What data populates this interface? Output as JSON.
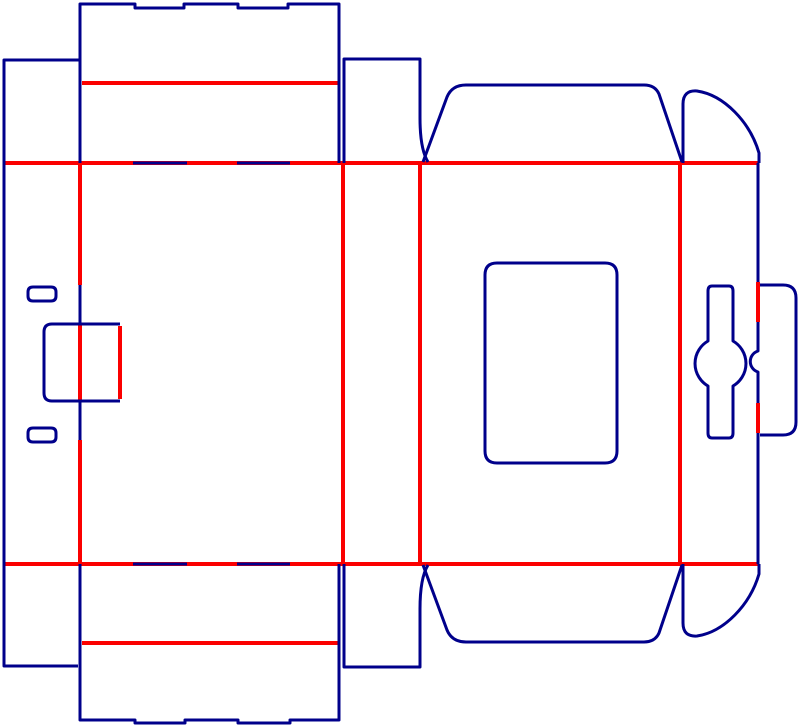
{
  "diagram": {
    "type": "packaging-dieline",
    "description": "Die-line template of a tuck/lock carton: cut lines in dark blue, crease (fold) lines in red",
    "canvas": {
      "width": 800,
      "height": 728,
      "background": "#ffffff"
    },
    "colors": {
      "cut": "#00008B",
      "crease": "#FB0000"
    },
    "stroke_width": {
      "cut": 3,
      "crease": 4
    },
    "crease_paths": [
      {
        "name": "fold-line-top",
        "d": "M 4,163 H 758"
      },
      {
        "name": "fold-line-bottom",
        "d": "M 4,564 H 758"
      },
      {
        "name": "top-tuck-flap-crease",
        "d": "M 82,83 H 338"
      },
      {
        "name": "bottom-tuck-flap-crease",
        "d": "M 82,643 H 338"
      },
      {
        "name": "glue-strip-fold",
        "d": "M 80,163 V 285 M 80,323 V 400 M 80,440 V 564"
      },
      {
        "name": "front-panel-right-fold",
        "d": "M 343,163 V 564"
      },
      {
        "name": "side-panel-right-fold",
        "d": "M 420,163 V 564"
      },
      {
        "name": "back-panel-right-fold",
        "d": "M 680,163 V 564"
      },
      {
        "name": "hook-tab-crease",
        "d": "M 120,326 V 399"
      },
      {
        "name": "right-tab-crease-upper",
        "d": "M 758,282 V 322"
      },
      {
        "name": "right-tab-crease-lower",
        "d": "M 758,403 V 433"
      }
    ],
    "cut_paths": [
      {
        "name": "glue-strip-outline",
        "d": "M 80,60 H 4 V 666 H 78"
      },
      {
        "name": "top-flap-outline",
        "d": "M 80,163 V 4 H 135 V 8 H 184 V 4 H 238 V 8 H 288 V 4 H 339 V 163"
      },
      {
        "name": "side-top-flap-outline",
        "d": "M 344,163 V 59 H 420 V 118 Q 420,149 428,162"
      },
      {
        "name": "back-top-dust-flap-outline",
        "d": "M 423,162 L 447,97 Q 452,85 466,85 H 644 Q 655,85 659,94 L 682,162"
      },
      {
        "name": "right-top-curved-flap-outline",
        "d": "M 683,163 L 683,104 Q 683,90 697,91 C 724,95 750,122 759,153 L 759,163"
      },
      {
        "name": "right-column-edge",
        "d": "M 758,163 V 282 M 758,322 V 351 A 11 11 0 0 0 758,372 V 403 M 758,433 V 564"
      },
      {
        "name": "right-lock-tab-outline",
        "d": "M 760,285 H 783 Q 796,285 796,298 V 422 Q 796,435 783,435 H 760"
      },
      {
        "name": "spinner-lock-bone-outline",
        "d": "M 712,286 H 729 Q 733,286 733,291 V 341 A 26 26 0 0 1 733,386 V 433 Q 733,438 729,438 H 712 Q 708,438 708,433 V 386 A 26 26 0 0 1 708,341 V 291 Q 708,286 712,286 Z"
      },
      {
        "name": "window-cutout-outline",
        "d": "M 497,263 H 605 Q 617,263 617,275 V 451 Q 617,463 605,463 H 497 Q 485,463 485,451 V 275 Q 485,263 497,263 Z"
      },
      {
        "name": "slot-top-outline",
        "d": "M 33,287 H 51 Q 56,287 56,292 V 296 Q 56,301 51,301 H 33 Q 28,301 28,296 V 292 Q 28,287 33,287 Z"
      },
      {
        "name": "slot-bottom-outline",
        "d": "M 33,428 H 51 Q 56,428 56,433 V 437 Q 56,442 51,442 H 33 Q 28,442 28,437 V 433 Q 28,428 33,428 Z"
      },
      {
        "name": "hook-tab-outline",
        "d": "M 120,324 H 52 Q 44,324 44,332 V 393 Q 44,401 52,401 H 120"
      },
      {
        "name": "bottom-flap-outline",
        "d": "M 80,564 V 720 H 135 V 723 H 185 V 720 H 238 V 723 H 290 V 720 H 339 V 564"
      },
      {
        "name": "side-bottom-flap-outline",
        "d": "M 344,564 V 667 H 420 V 609 Q 420,578 428,565"
      },
      {
        "name": "back-bottom-dust-flap-outline",
        "d": "M 423,565 L 447,630 Q 452,642 466,642 H 644 Q 655,642 659,633 L 682,565"
      },
      {
        "name": "right-bottom-curved-flap-outline",
        "d": "M 683,564 L 683,623 Q 683,637 697,636 C 724,632 750,605 759,574 L 759,564"
      },
      {
        "name": "fold-slits-top",
        "d": "M 133,163 H 187 M 237,163 H 290"
      },
      {
        "name": "fold-slits-bottom",
        "d": "M 133,564 H 187 M 237,564 H 290"
      },
      {
        "name": "glue-fold-slits",
        "d": "M 80,285 V 323 M 80,400 V 440"
      }
    ]
  }
}
